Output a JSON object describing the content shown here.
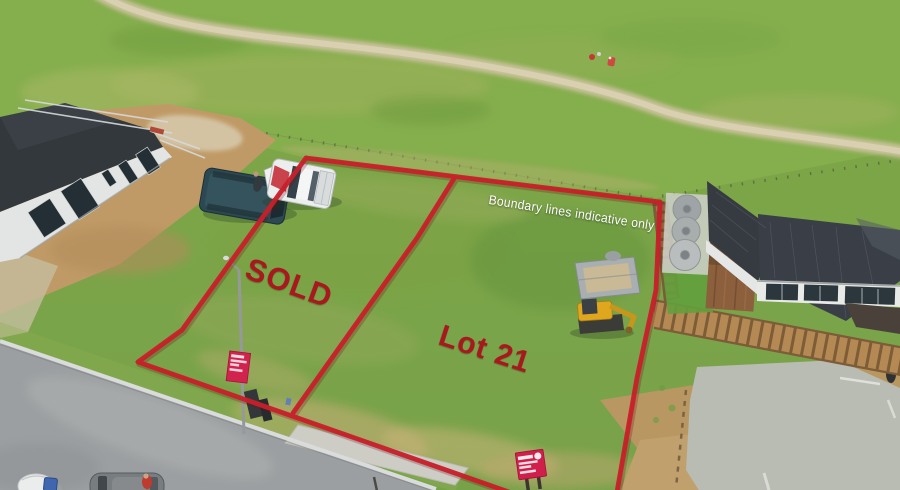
{
  "labels": {
    "sold": "SOLD",
    "lot": "Lot 21",
    "boundary_note": "Boundary lines indicative only"
  },
  "colors": {
    "boundary_line_red": "#c8202a",
    "label_red": "#a8191f",
    "note_white": "#ffffff",
    "paddock_green": "#84ad4c",
    "lot_green": "#7aa346",
    "road_grey": "#9c9fa1",
    "dirt_tan": "#c09a66",
    "roof_charcoal": "#363b42"
  }
}
